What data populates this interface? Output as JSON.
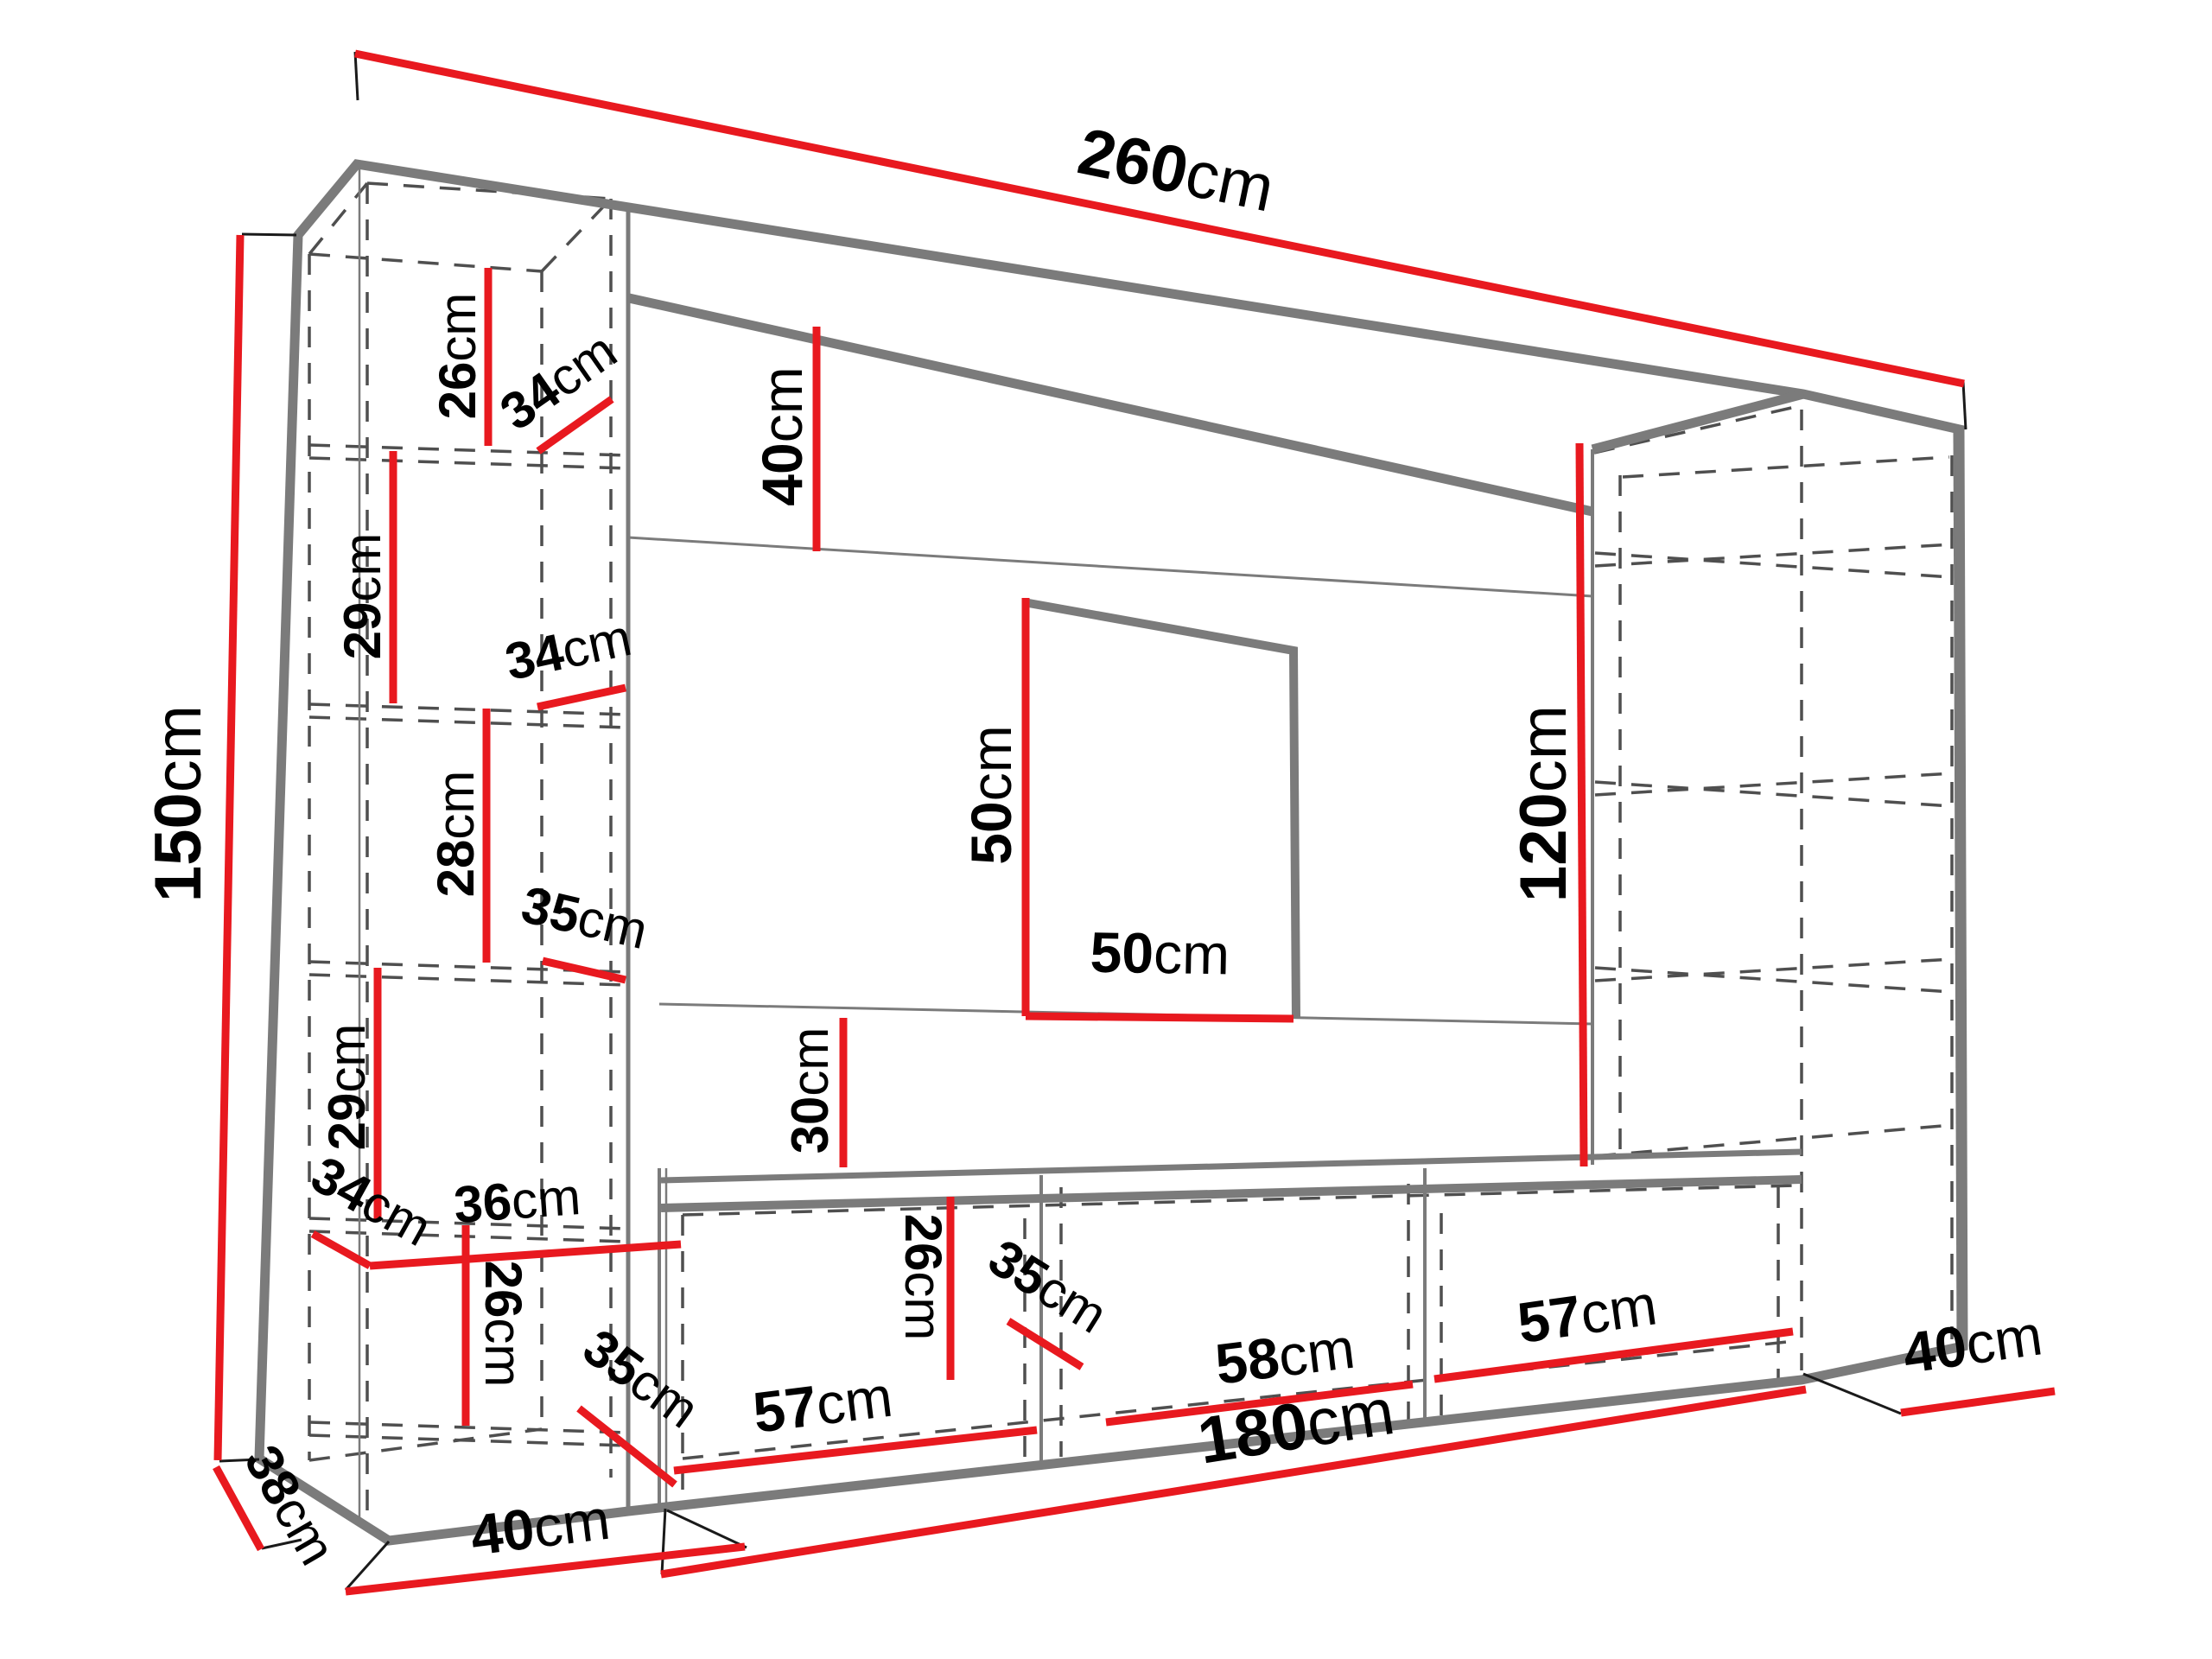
{
  "figure": "wall-unit-dimension-diagram",
  "colors": {
    "dimension": "#e8191f",
    "outline": "#7b7b7b",
    "dashed": "#4f4f4f",
    "tick": "#1a1a1a",
    "label": "#000000"
  },
  "dimensions": {
    "overall_width": {
      "num": "260",
      "unit": "cm"
    },
    "overall_height": {
      "num": "150",
      "unit": "cm"
    },
    "left_top_gap": {
      "num": "26",
      "unit": "cm"
    },
    "left_depth_top": {
      "num": "34",
      "unit": "cm"
    },
    "left_shelf_1": {
      "num": "29",
      "unit": "cm"
    },
    "left_shelf_2": {
      "num": "28",
      "unit": "cm"
    },
    "left_depth_mid": {
      "num": "34",
      "unit": "cm"
    },
    "left_depth_shelf": {
      "num": "35",
      "unit": "cm"
    },
    "left_shelf_3": {
      "num": "29",
      "unit": "cm"
    },
    "left_depth_bottom": {
      "num": "34",
      "unit": "cm"
    },
    "left_inner_width": {
      "num": "36",
      "unit": "cm"
    },
    "left_bottom_gap": {
      "num": "26",
      "unit": "cm"
    },
    "left_depth_base": {
      "num": "35",
      "unit": "cm"
    },
    "base_depth": {
      "num": "38",
      "unit": "cm"
    },
    "left_width": {
      "num": "40",
      "unit": "cm"
    },
    "top_panel_height": {
      "num": "40",
      "unit": "cm"
    },
    "tv_height": {
      "num": "50",
      "unit": "cm"
    },
    "tv_width": {
      "num": "50",
      "unit": "cm"
    },
    "panel_gap": {
      "num": "30",
      "unit": "cm"
    },
    "bench_height": {
      "num": "26",
      "unit": "cm"
    },
    "bench_depth": {
      "num": "35",
      "unit": "cm"
    },
    "bench_left": {
      "num": "57",
      "unit": "cm"
    },
    "bench_mid": {
      "num": "58",
      "unit": "cm"
    },
    "bench_right": {
      "num": "57",
      "unit": "cm"
    },
    "bench_width": {
      "num": "180",
      "unit": "cm"
    },
    "right_height": {
      "num": "120",
      "unit": "cm"
    },
    "right_depth": {
      "num": "40",
      "unit": "cm"
    }
  }
}
